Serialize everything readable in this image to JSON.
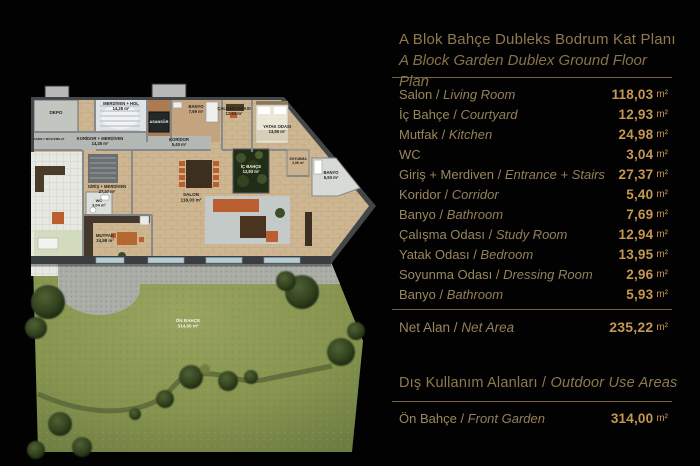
{
  "panel": {
    "separator": " / ",
    "title_tr": "A Blok Bahçe Dubleks Bodrum Kat Planı",
    "title_en": "A Block Garden Dublex Ground Floor Plan",
    "rooms": [
      {
        "tr": "Salon",
        "en": "Living Room",
        "value": "118,03",
        "unit": "m²"
      },
      {
        "tr": "İç Bahçe",
        "en": "Courtyard",
        "value": "12,93",
        "unit": "m²"
      },
      {
        "tr": "Mutfak",
        "en": "Kitchen",
        "value": "24,98",
        "unit": "m²"
      },
      {
        "tr": "WC",
        "en": "",
        "value": "3,04",
        "unit": "m²"
      },
      {
        "tr": "Giriş + Merdiven",
        "en": "Entrance + Stairs",
        "value": "27,37",
        "unit": "m²"
      },
      {
        "tr": "Koridor",
        "en": "Corridor",
        "value": "5,40",
        "unit": "m²"
      },
      {
        "tr": "Banyo",
        "en": "Bathroom",
        "value": "7,69",
        "unit": "m²"
      },
      {
        "tr": "Çalışma Odası",
        "en": "Study Room",
        "value": "12,94",
        "unit": "m²"
      },
      {
        "tr": "Yatak Odası",
        "en": "Bedroom",
        "value": "13,95",
        "unit": "m²"
      },
      {
        "tr": "Soyunma Odası",
        "en": "Dressing Room",
        "value": "2,96",
        "unit": "m²"
      },
      {
        "tr": "Banyo",
        "en": "Bathroom",
        "value": "5,93",
        "unit": "m²"
      }
    ],
    "net": {
      "tr": "Net Alan",
      "en": "Net Area",
      "value": "235,22",
      "unit": "m²"
    },
    "outdoor_title_tr": "Dış Kullanım Alanları",
    "outdoor_title_en": "Outdoor Use Areas",
    "outdoor_row": {
      "tr": "Ön Bahçe",
      "en": "Front Garden",
      "value": "314,00",
      "unit": "m²"
    }
  },
  "plan": {
    "labels": [
      {
        "name": "DEPO",
        "area": ""
      },
      {
        "name": "MERDİVEN + HOL",
        "area": "14,28 m²"
      },
      {
        "name": "ASANSÖR",
        "area": ""
      },
      {
        "name": "BANYO",
        "area": "7,69 m²"
      },
      {
        "name": "KORİDOR + MERDİVEN",
        "area": "14,35 m²"
      },
      {
        "name": "KORİDOR",
        "area": "5,40 m²"
      },
      {
        "name": "ÇALIŞMA ODASI",
        "area": "12,94 m²"
      },
      {
        "name": "YATAK ODASI",
        "area": "13,95 m²"
      },
      {
        "name": "İÇ BAHÇE",
        "area": "12,93 m²"
      },
      {
        "name": "SOYUNMA",
        "area": "2,96 m²"
      },
      {
        "name": "BANYO",
        "area": "5,93 m²"
      },
      {
        "name": "GİRİŞ + MERDİVEN",
        "area": "27,37 m²"
      },
      {
        "name": "WC",
        "area": "3,04 m²"
      },
      {
        "name": "SALON",
        "area": "118,03 m²"
      },
      {
        "name": "MUTFAK",
        "area": "24,98 m²"
      },
      {
        "name": "ÖN BAHÇE",
        "area": "314,00 m²"
      },
      {
        "name": "DAİRE 7 MÜŞTEMİLAT",
        "area": ""
      }
    ]
  },
  "colors": {
    "background": "#020202",
    "title_gold": "#8f7a4f",
    "label_tan": "#9a875f",
    "value_gold": "#c59753",
    "divider": "#75643f",
    "grass_green": "#8d9a56",
    "tree_green": "#2b3a1d",
    "wood_floor": "#cdb691",
    "terrace_gray": "#a9ada6",
    "courtyard_green": "#2c3b1c",
    "furniture_orange": "#bb5f31",
    "wall_gray": "#43474a"
  }
}
